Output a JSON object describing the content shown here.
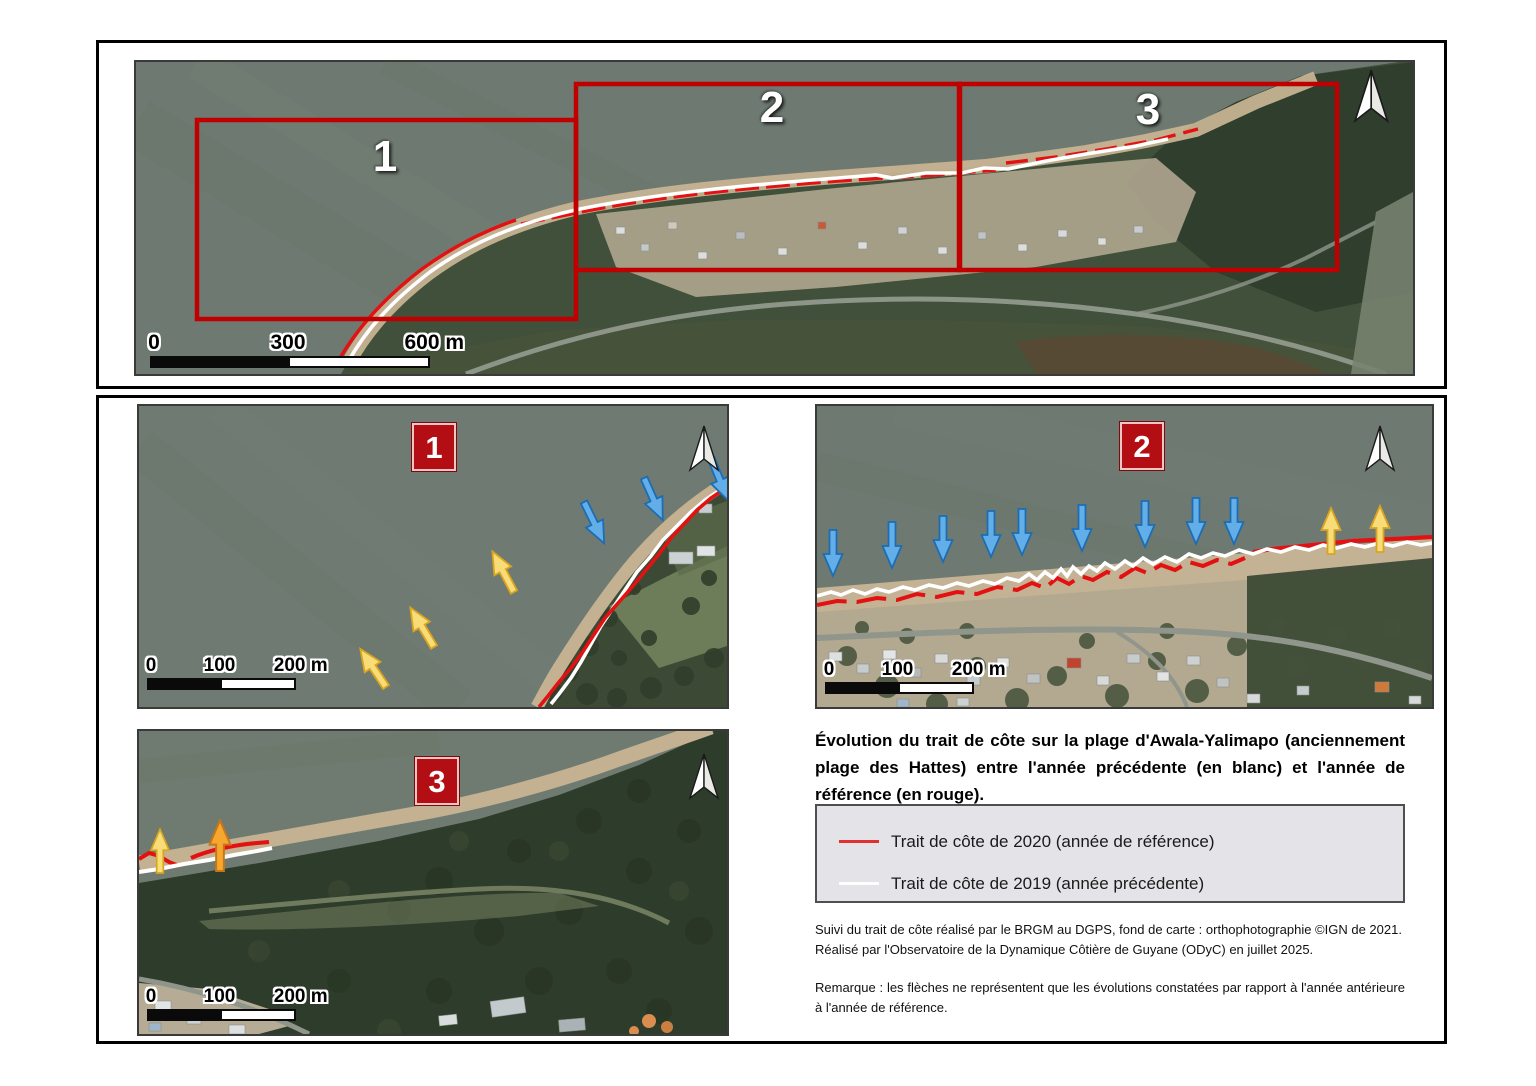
{
  "overview": {
    "region_labels": [
      "1",
      "2",
      "3"
    ],
    "scalebar": {
      "start": "0",
      "mid": "300",
      "end": "600 m"
    }
  },
  "detail_maps": [
    {
      "badge": "1",
      "scalebar": {
        "start": "0",
        "mid": "100",
        "end": "200 m"
      }
    },
    {
      "badge": "2",
      "scalebar": {
        "start": "0",
        "mid": "100",
        "end": "200 m"
      }
    },
    {
      "badge": "3",
      "scalebar": {
        "start": "0",
        "mid": "100",
        "end": "200 m"
      }
    }
  ],
  "caption": {
    "title": "Évolution du trait de côte sur la plage d'Awala-Yalimapo (anciennement plage des Hattes) entre l'année précédente (en blanc) et l'année de référence (en rouge).",
    "legend_items": [
      {
        "label": "Trait de côte de 2020 (année de référence)",
        "color": "#e03030"
      },
      {
        "label": "Trait de côte de 2019 (année précédente)",
        "color": "#ffffff"
      }
    ],
    "credits": "Suivi du trait de côte réalisé par le BRGM au DGPS, fond de carte : orthophotographie ©IGN de 2021. Réalisé par l'Observatoire de la Dynamique Côtière de Guyane (ODyC) en juillet 2025.",
    "remark": "Remarque : les flèches ne représentent que les évolutions constatées par rapport à l'année antérieure à l'année de référence."
  },
  "colors": {
    "shoreline_2020": "#e31111",
    "shoreline_2019": "#ffffff",
    "region_rectangle": "#c00000",
    "erosion_arrow_blue": "#62aee8",
    "accretion_arrow_yellow": "#f8dc78",
    "accretion_arrow_orange": "#f6a72e"
  }
}
